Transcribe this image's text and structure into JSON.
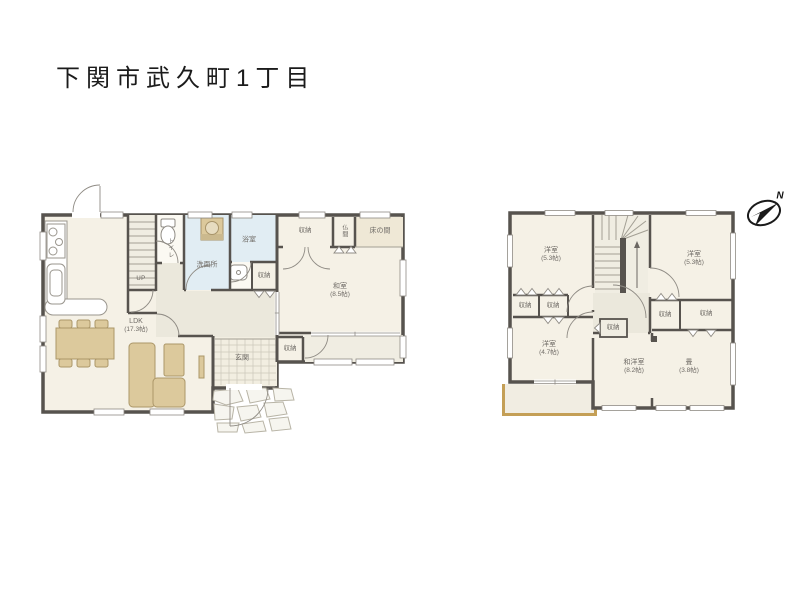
{
  "title": "下関市武久町1丁目",
  "compass": {
    "north": "N"
  },
  "floor1": {
    "ldk": {
      "name": "LDK",
      "size": "(17.3帖)"
    },
    "washitsu": {
      "name": "和室",
      "size": "(8.5帖)"
    },
    "genkan": {
      "name": "玄関"
    },
    "toilet": {
      "name": "トイレ"
    },
    "senmenjo": {
      "name": "洗面所"
    },
    "bathroom": {
      "name": "浴室"
    },
    "butsuma": {
      "name": "仏間"
    },
    "tokonoma": {
      "name": "床の間"
    },
    "closet_hall": {
      "name": "収納"
    },
    "closet_ne": {
      "name": "収納"
    },
    "closet_entry": {
      "name": "収納"
    },
    "stairs_label": "UP"
  },
  "floor2": {
    "bedroom_nw": {
      "name": "洋室",
      "size": "(5.3帖)"
    },
    "bedroom_ne": {
      "name": "洋室",
      "size": "(5.3帖)"
    },
    "bedroom_sw": {
      "name": "洋室",
      "size": "(4.7帖)"
    },
    "wayo_room": {
      "name": "和洋室",
      "size": "(8.2帖)"
    },
    "tatami_room": {
      "name": "畳",
      "size": "(3.8帖)"
    },
    "closet_1": {
      "name": "収納"
    },
    "closet_2": {
      "name": "収納"
    },
    "closet_hall": {
      "name": "収納"
    },
    "closet_3": {
      "name": "収納"
    },
    "closet_4": {
      "name": "収納"
    }
  },
  "colors": {
    "wall": "#57534e",
    "room": "#f5f1e6",
    "wet_room": "#e1edf3",
    "hall": "#ebe8dc",
    "furniture": "#dcc99c",
    "balcony_edge": "#c49f56",
    "window_line": "#8f8b84",
    "label_text": "#6f6b66"
  }
}
